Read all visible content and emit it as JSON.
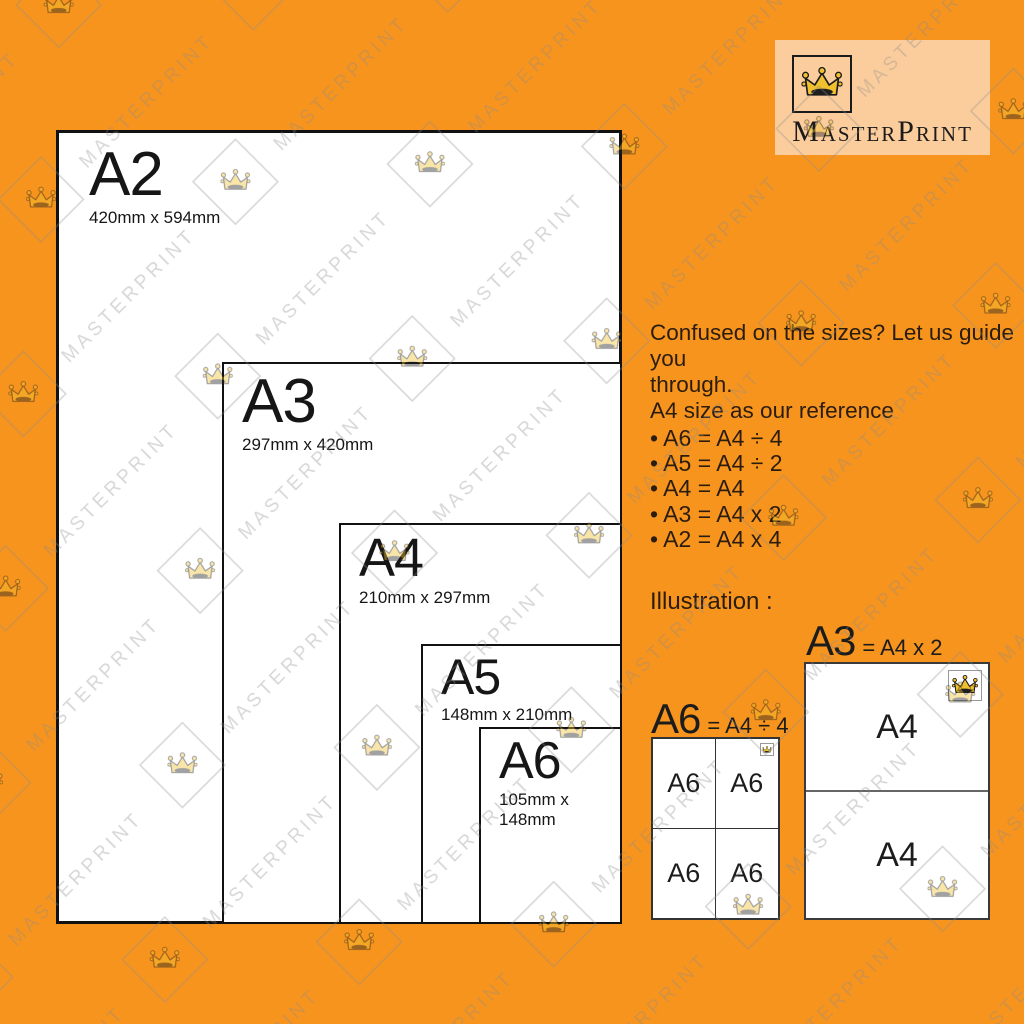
{
  "brand": {
    "name": "MasterPrint",
    "logo_icon": "crown-icon"
  },
  "watermark": {
    "text": "MASTERPRINT"
  },
  "colors": {
    "background": "#F7941E",
    "paper": "#FFFFFF",
    "logo_panel": "#FBCD9C",
    "crown_gold": "#F0C02E",
    "ink": "#1A1A1A",
    "guide_text": "#2B1D0E"
  },
  "paper_diagram": {
    "sizes": [
      {
        "label": "A2",
        "dimensions": "420mm x 594mm"
      },
      {
        "label": "A3",
        "dimensions": "297mm x 420mm"
      },
      {
        "label": "A4",
        "dimensions": "210mm x 297mm"
      },
      {
        "label": "A5",
        "dimensions": "148mm x 210mm"
      },
      {
        "label": "A6",
        "dimensions": "105mm x 148mm"
      }
    ]
  },
  "guide": {
    "intro_line1": "Confused on the sizes? Let us guide you",
    "intro_line2": "through.",
    "intro_line3": "A4 size as our reference",
    "bullets": [
      "• A6 = A4 ÷ 4",
      "• A5 = A4 ÷ 2",
      "• A4 = A4",
      "• A3 = A4 x 2",
      "• A2 = A4 x 4"
    ],
    "illustration_heading": "Illustration :"
  },
  "illustrations": {
    "a6": {
      "title": "A6",
      "equation": "= A4 ÷ 4",
      "cells": [
        "A6",
        "A6",
        "A6",
        "A6"
      ]
    },
    "a3": {
      "title": "A3",
      "equation": "= A4 x 2",
      "halves": [
        "A4",
        "A4"
      ]
    }
  }
}
